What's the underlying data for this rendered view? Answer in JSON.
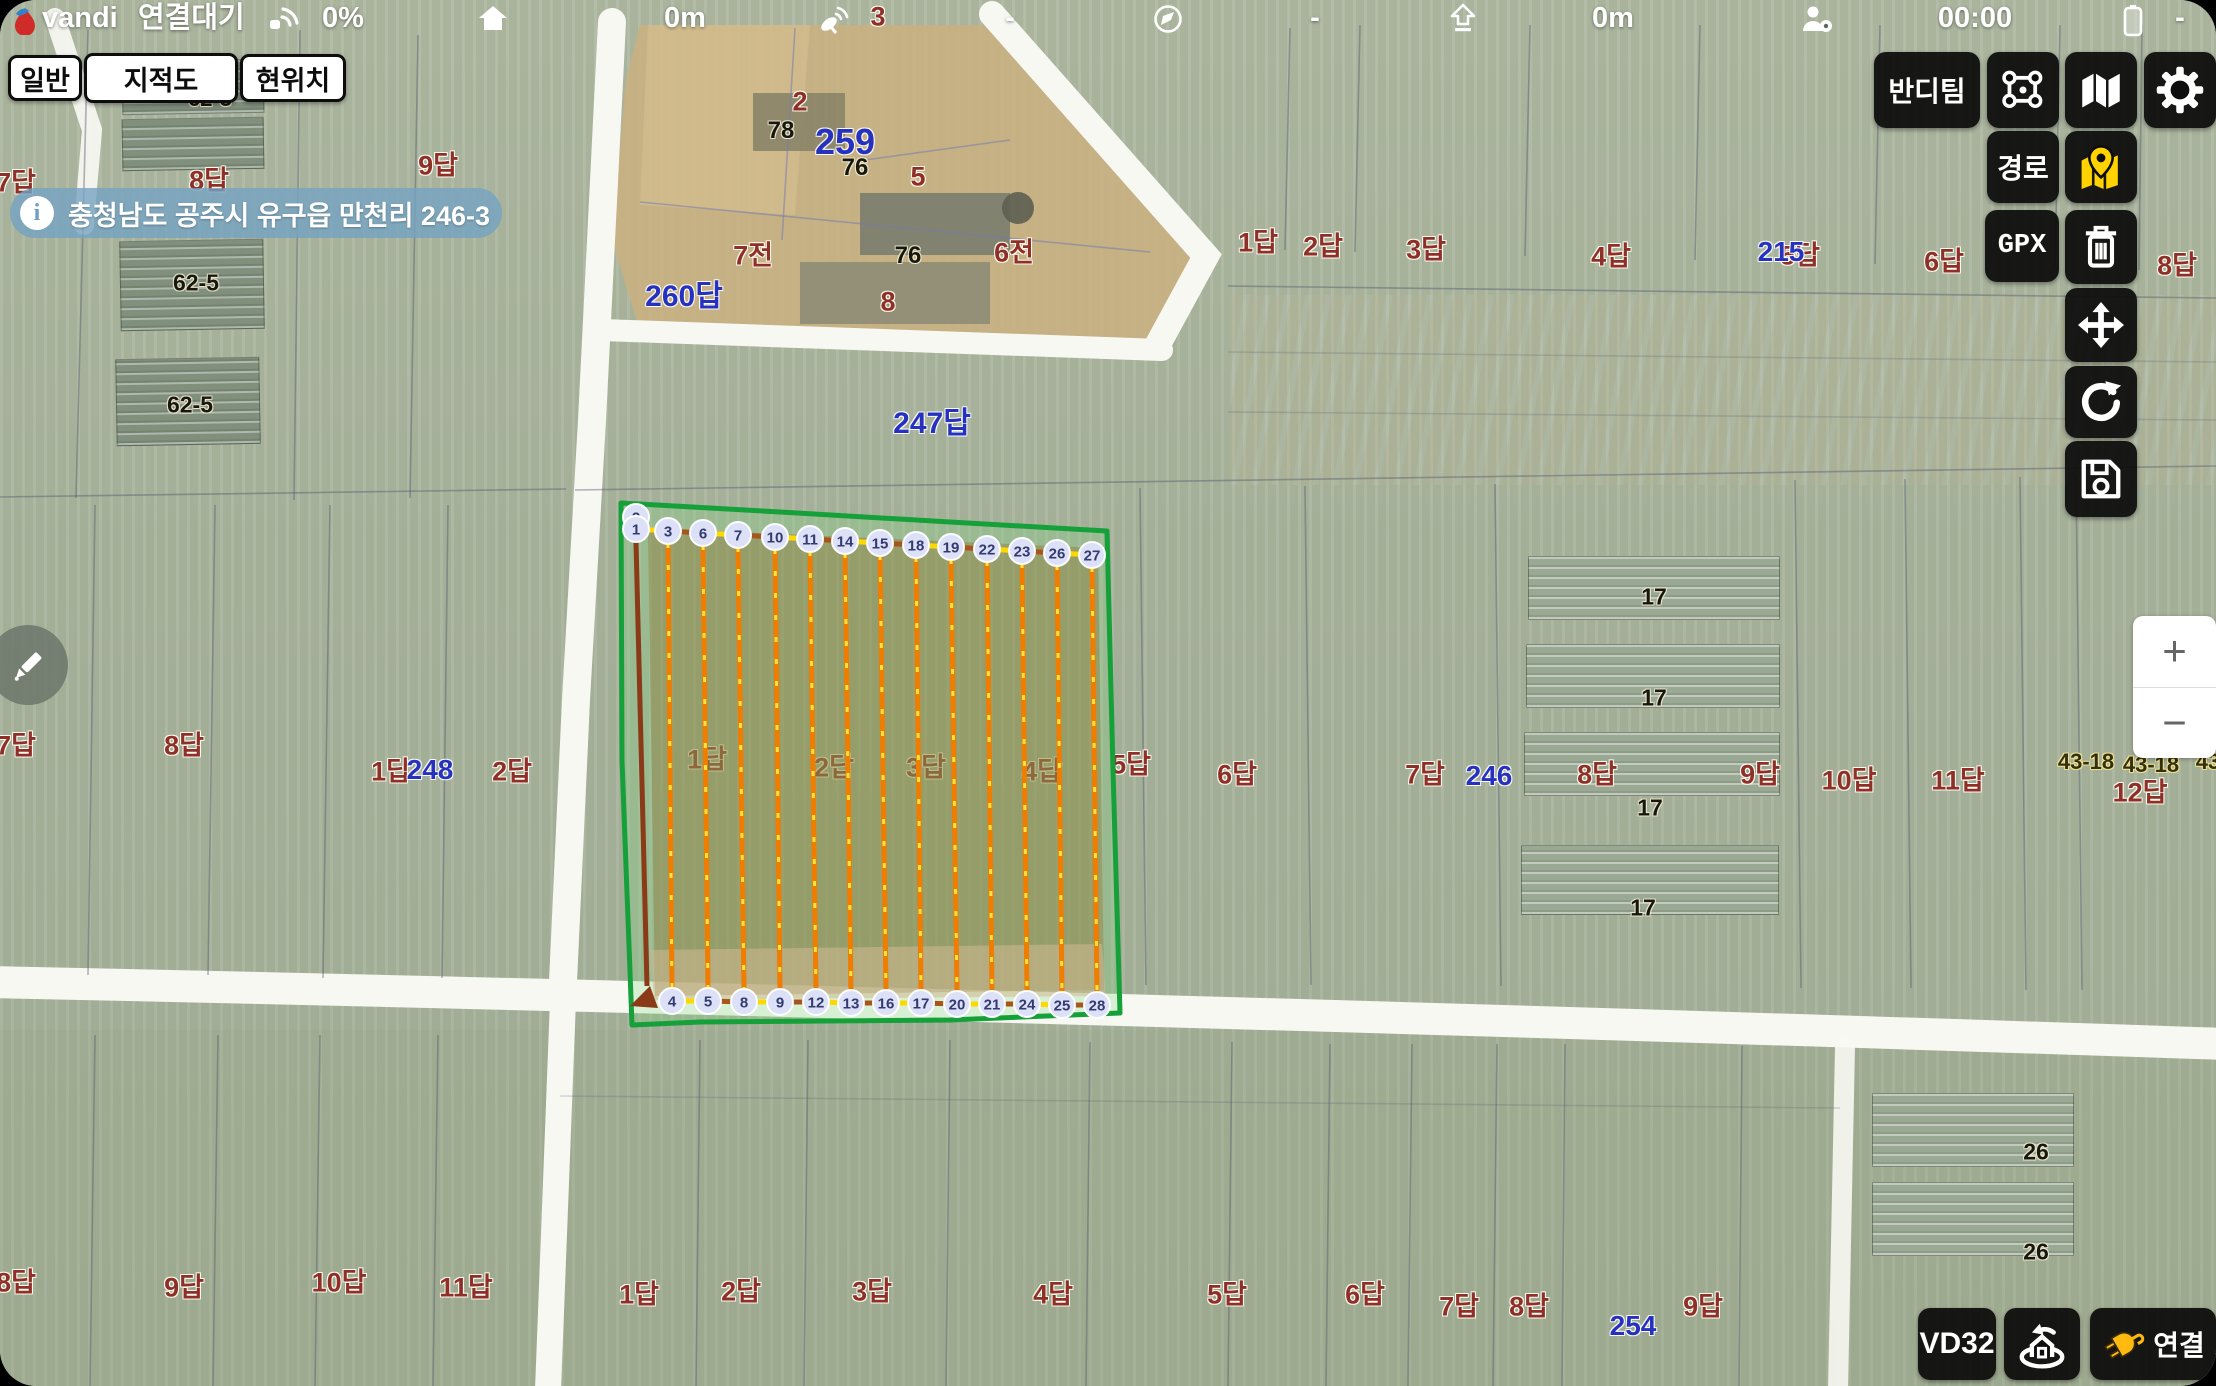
{
  "status_bar": {
    "brand": "vandi",
    "connection_state": "연결대기",
    "battery_percent": "0%",
    "home_distance": "0m",
    "satellite_count": "3",
    "metric_dash": "-",
    "compass_dash": "-",
    "altitude": "0m",
    "flight_time": "00:00",
    "battery_dash": "-"
  },
  "map_type_buttons": {
    "general": "일반",
    "cadastral": "지적도",
    "current_location": "현위치"
  },
  "address_banner": {
    "text": "충청남도 공주시 유구읍 만천리 246-3"
  },
  "right_panel": {
    "team": "반디팀",
    "route": "경로",
    "gpx": "GPX"
  },
  "bottom_right": {
    "model": "VD32",
    "connect": "연결"
  },
  "zoom_control": {
    "zoom_in": "+",
    "zoom_out": "−"
  },
  "colors": {
    "boundary_green": "#15a03a",
    "spray_line_orange": "#f07c00",
    "dash_yellow": "#ffe53d",
    "connector_yellow": "#ffd800",
    "transit_brown": "#a8551c",
    "entry_brown": "#8a3a16",
    "waypoint_fill": "#dde1f7",
    "banner_blue": "#74a3c2",
    "pin_yellow": "#ffd200",
    "plug_yellow": "#ffb90f"
  },
  "map_labels": [
    {
      "t": "3",
      "x": 878,
      "y": 17,
      "c": "red",
      "s": 27
    },
    {
      "t": "62-3",
      "x": 210,
      "y": 99,
      "c": "black",
      "s": 22
    },
    {
      "t": "7답",
      "x": 16,
      "y": 183,
      "c": "red"
    },
    {
      "t": "8답",
      "x": 209,
      "y": 181,
      "c": "red"
    },
    {
      "t": "9답",
      "x": 438,
      "y": 166,
      "c": "red"
    },
    {
      "t": "62-5",
      "x": 196,
      "y": 283,
      "c": "black",
      "s": 23
    },
    {
      "t": "62-5",
      "x": 190,
      "y": 405,
      "c": "black",
      "s": 23
    },
    {
      "t": "2",
      "x": 800,
      "y": 102,
      "c": "red"
    },
    {
      "t": "78",
      "x": 781,
      "y": 131,
      "c": "black",
      "s": 24
    },
    {
      "t": "259",
      "x": 845,
      "y": 142,
      "c": "blue",
      "s": 36
    },
    {
      "t": "76",
      "x": 855,
      "y": 168,
      "c": "black",
      "s": 24
    },
    {
      "t": "5",
      "x": 918,
      "y": 177,
      "c": "red"
    },
    {
      "t": "7전",
      "x": 753,
      "y": 256,
      "c": "red"
    },
    {
      "t": "76",
      "x": 908,
      "y": 256,
      "c": "black",
      "s": 24
    },
    {
      "t": "6전",
      "x": 1014,
      "y": 253,
      "c": "red"
    },
    {
      "t": "260답",
      "x": 684,
      "y": 297,
      "c": "blue",
      "s": 30
    },
    {
      "t": "8",
      "x": 888,
      "y": 302,
      "c": "red"
    },
    {
      "t": "247답",
      "x": 932,
      "y": 424,
      "c": "blue",
      "s": 30
    },
    {
      "t": "1답",
      "x": 1258,
      "y": 243,
      "c": "red"
    },
    {
      "t": "2답",
      "x": 1323,
      "y": 247,
      "c": "red"
    },
    {
      "t": "3답",
      "x": 1426,
      "y": 250,
      "c": "red"
    },
    {
      "t": "4답",
      "x": 1611,
      "y": 257,
      "c": "red"
    },
    {
      "t": "5답",
      "x": 1800,
      "y": 256,
      "c": "red"
    },
    {
      "t": "215",
      "x": 1781,
      "y": 252,
      "c": "blue",
      "s": 28
    },
    {
      "t": "6답",
      "x": 1944,
      "y": 262,
      "c": "red"
    },
    {
      "t": "8답",
      "x": 2177,
      "y": 266,
      "c": "red"
    },
    {
      "t": "7답",
      "x": 16,
      "y": 746,
      "c": "red"
    },
    {
      "t": "8답",
      "x": 184,
      "y": 746,
      "c": "red"
    },
    {
      "t": "1답",
      "x": 391,
      "y": 772,
      "c": "red"
    },
    {
      "t": "248",
      "x": 430,
      "y": 770,
      "c": "blue",
      "s": 28
    },
    {
      "t": "2답",
      "x": 512,
      "y": 772,
      "c": "red"
    },
    {
      "t": "1답",
      "x": 707,
      "y": 760,
      "c": "red"
    },
    {
      "t": "2답",
      "x": 834,
      "y": 768,
      "c": "red"
    },
    {
      "t": "3답",
      "x": 926,
      "y": 768,
      "c": "red"
    },
    {
      "t": "4답",
      "x": 1042,
      "y": 772,
      "c": "red"
    },
    {
      "t": "5답",
      "x": 1131,
      "y": 765,
      "c": "red"
    },
    {
      "t": "6답",
      "x": 1237,
      "y": 775,
      "c": "red"
    },
    {
      "t": "7답",
      "x": 1425,
      "y": 775,
      "c": "red"
    },
    {
      "t": "246",
      "x": 1489,
      "y": 776,
      "c": "blue",
      "s": 28
    },
    {
      "t": "8답",
      "x": 1597,
      "y": 775,
      "c": "red"
    },
    {
      "t": "9답",
      "x": 1760,
      "y": 775,
      "c": "red"
    },
    {
      "t": "10답",
      "x": 1849,
      "y": 781,
      "c": "red"
    },
    {
      "t": "11답",
      "x": 1958,
      "y": 781,
      "c": "red"
    },
    {
      "t": "43-18",
      "x": 2086,
      "y": 762,
      "c": "dark",
      "s": 22
    },
    {
      "t": "43-18",
      "x": 2151,
      "y": 765,
      "c": "dark",
      "s": 22
    },
    {
      "t": "43",
      "x": 2208,
      "y": 762,
      "c": "dark",
      "s": 22
    },
    {
      "t": "12답",
      "x": 2140,
      "y": 793,
      "c": "red"
    },
    {
      "t": "17",
      "x": 1654,
      "y": 597,
      "c": "black",
      "s": 23
    },
    {
      "t": "17",
      "x": 1654,
      "y": 698,
      "c": "black",
      "s": 23
    },
    {
      "t": "17",
      "x": 1650,
      "y": 808,
      "c": "black",
      "s": 23
    },
    {
      "t": "17",
      "x": 1643,
      "y": 908,
      "c": "black",
      "s": 23
    },
    {
      "t": "26",
      "x": 2036,
      "y": 1152,
      "c": "black",
      "s": 23
    },
    {
      "t": "26",
      "x": 2036,
      "y": 1252,
      "c": "black",
      "s": 23
    },
    {
      "t": "8답",
      "x": 16,
      "y": 1283,
      "c": "red"
    },
    {
      "t": "9답",
      "x": 184,
      "y": 1288,
      "c": "red"
    },
    {
      "t": "10답",
      "x": 339,
      "y": 1283,
      "c": "red"
    },
    {
      "t": "11답",
      "x": 466,
      "y": 1288,
      "c": "red"
    },
    {
      "t": "1답",
      "x": 639,
      "y": 1295,
      "c": "red"
    },
    {
      "t": "2답",
      "x": 741,
      "y": 1292,
      "c": "red"
    },
    {
      "t": "3답",
      "x": 872,
      "y": 1292,
      "c": "red"
    },
    {
      "t": "4답",
      "x": 1053,
      "y": 1295,
      "c": "red"
    },
    {
      "t": "5답",
      "x": 1227,
      "y": 1295,
      "c": "red"
    },
    {
      "t": "6답",
      "x": 1365,
      "y": 1295,
      "c": "red"
    },
    {
      "t": "7답",
      "x": 1459,
      "y": 1307,
      "c": "red"
    },
    {
      "t": "8답",
      "x": 1529,
      "y": 1307,
      "c": "red"
    },
    {
      "t": "254",
      "x": 1633,
      "y": 1326,
      "c": "blue",
      "s": 28
    },
    {
      "t": "9답",
      "x": 1703,
      "y": 1307,
      "c": "red"
    }
  ],
  "flight_plan": {
    "boundary_points": "621,503 780,512 950,522 1107,531 1113,770 1120,1013 950,1020 700,1022 632,1025 622,760",
    "boundary_fill": "rgba(130,215,130,0.28)",
    "interior_points": "648,528 1098,548 1104,990 655,996",
    "interior_fill": "rgba(143,120,52,0.42)",
    "strip_points": "650,950 1102,944 1106,996 654,1000",
    "strip_fill": "rgba(208,184,148,0.55)",
    "entry_line": {
      "x1": 636,
      "y1": 542,
      "x2": 647,
      "y2": 986
    },
    "entry_arrow_points": "630,1006 650,986 658,1008",
    "hidden_waypoint": {
      "n": "2",
      "x": 636,
      "y": 517
    },
    "waypoints_top": [
      {
        "n": "1",
        "x": 636,
        "y": 529
      },
      {
        "n": "3",
        "x": 668,
        "y": 531
      },
      {
        "n": "6",
        "x": 703,
        "y": 533
      },
      {
        "n": "7",
        "x": 738,
        "y": 535
      },
      {
        "n": "10",
        "x": 775,
        "y": 537
      },
      {
        "n": "11",
        "x": 810,
        "y": 539
      },
      {
        "n": "14",
        "x": 845,
        "y": 541
      },
      {
        "n": "15",
        "x": 880,
        "y": 543
      },
      {
        "n": "18",
        "x": 916,
        "y": 545
      },
      {
        "n": "19",
        "x": 951,
        "y": 547
      },
      {
        "n": "22",
        "x": 987,
        "y": 549
      },
      {
        "n": "23",
        "x": 1022,
        "y": 551
      },
      {
        "n": "26",
        "x": 1057,
        "y": 553
      },
      {
        "n": "27",
        "x": 1092,
        "y": 555
      }
    ],
    "waypoints_bottom": [
      {
        "n": "4",
        "x": 672,
        "y": 1001
      },
      {
        "n": "5",
        "x": 708,
        "y": 1001
      },
      {
        "n": "8",
        "x": 744,
        "y": 1002
      },
      {
        "n": "9",
        "x": 780,
        "y": 1002
      },
      {
        "n": "12",
        "x": 816,
        "y": 1002
      },
      {
        "n": "13",
        "x": 851,
        "y": 1003
      },
      {
        "n": "16",
        "x": 886,
        "y": 1003
      },
      {
        "n": "17",
        "x": 921,
        "y": 1003
      },
      {
        "n": "20",
        "x": 957,
        "y": 1004
      },
      {
        "n": "21",
        "x": 992,
        "y": 1004
      },
      {
        "n": "24",
        "x": 1027,
        "y": 1004
      },
      {
        "n": "25",
        "x": 1062,
        "y": 1005
      },
      {
        "n": "28",
        "x": 1097,
        "y": 1005
      }
    ]
  }
}
